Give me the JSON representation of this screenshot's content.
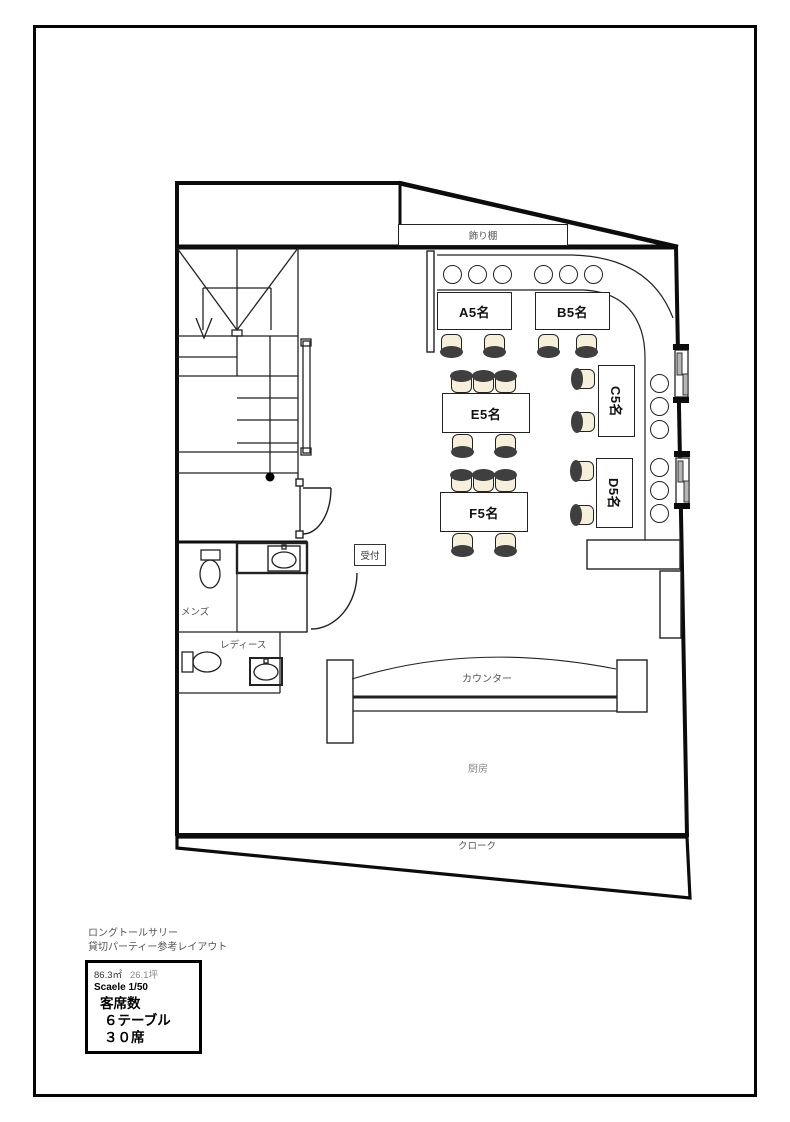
{
  "title": {
    "line1": "ロングトールサリー",
    "line2": "貸切パーティー参考レイアウト"
  },
  "info_box": {
    "area_sqm": "86.3㎡",
    "area_tsubo": "26.1坪",
    "scale_label": "Scaele 1/50",
    "seating_header": "客席数",
    "seating_tables": "６テーブル",
    "seating_seats": "３０席"
  },
  "rooms": {
    "shelf": "飾り棚",
    "reception": "受付",
    "mens": "メンズ",
    "ladies": "レディース",
    "counter": "カウンター",
    "kitchen": "厨房",
    "cloak": "クローク"
  },
  "tables": [
    {
      "id": "A",
      "label": "A5名"
    },
    {
      "id": "B",
      "label": "B5名"
    },
    {
      "id": "C",
      "label": "C5名"
    },
    {
      "id": "D",
      "label": "D5名"
    },
    {
      "id": "E",
      "label": "E5名"
    },
    {
      "id": "F",
      "label": "F5名"
    }
  ],
  "colors": {
    "line": "#111111",
    "chair_fill": "#f6f0da",
    "label_gray": "#555555"
  }
}
